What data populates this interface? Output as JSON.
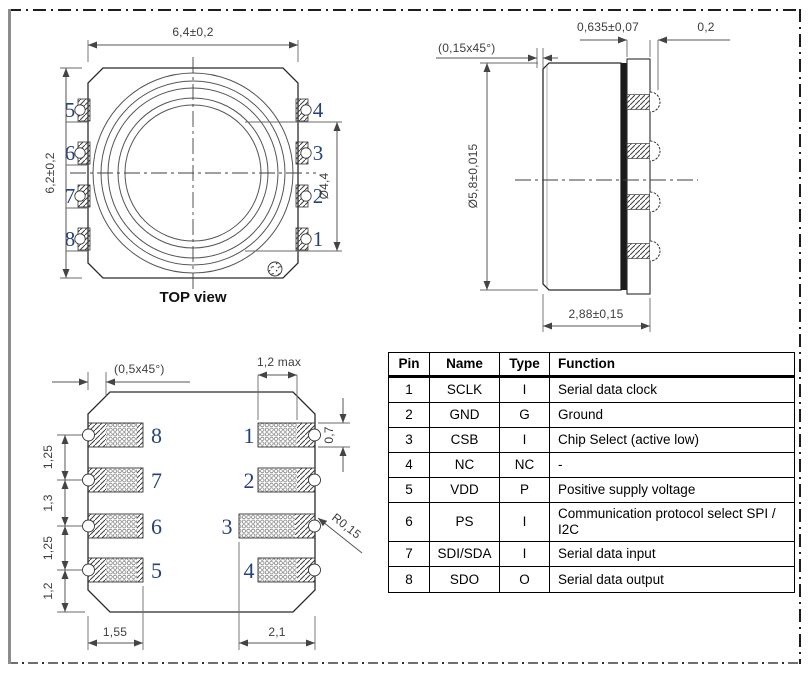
{
  "top_view": {
    "caption": "TOP view",
    "dim_width": "6,4±0,2",
    "dim_height": "6,2±0,2",
    "dim_cap_opening": "Ø4,4",
    "pins_left": [
      "5",
      "6",
      "7",
      "8"
    ],
    "pins_right": [
      "4",
      "3",
      "2",
      "1"
    ]
  },
  "side_view": {
    "dim_substrate": "0,635±0,07",
    "dim_castellation": "0,2",
    "dim_chamfer": "(0,15x45°)",
    "dim_diameter": "Ø5,8±0,015",
    "dim_height": "2,88±0,15"
  },
  "bottom_view": {
    "dim_chamfer": "(0,5x45°)",
    "dim_pad_length_max": "1,2 max",
    "dim_pad_width": "0,7",
    "dim_pitch_1": "1,25",
    "dim_pitch_2": "1,3",
    "dim_pitch_3": "1,25",
    "dim_edge": "1,2",
    "dim_left_pad_length": "1,55",
    "dim_pad3_length": "2,1",
    "dim_notch_radius": "R0,15",
    "pins_left": [
      "8",
      "7",
      "6",
      "5"
    ],
    "pins_right": [
      "1",
      "2",
      "3",
      "4"
    ]
  },
  "pin_table": {
    "headers": [
      "Pin",
      "Name",
      "Type",
      "Function"
    ],
    "rows": [
      {
        "pin": "1",
        "name": "SCLK",
        "type": "I",
        "function": "Serial data clock"
      },
      {
        "pin": "2",
        "name": "GND",
        "type": "G",
        "function": "Ground"
      },
      {
        "pin": "3",
        "name": "CSB",
        "type": "I",
        "function": "Chip Select (active low)"
      },
      {
        "pin": "4",
        "name": "NC",
        "type": "NC",
        "function": "-"
      },
      {
        "pin": "5",
        "name": "VDD",
        "type": "P",
        "function": "Positive supply voltage"
      },
      {
        "pin": "6",
        "name": "PS",
        "type": "I",
        "function": "Communication protocol select SPI / I2C"
      },
      {
        "pin": "7",
        "name": "SDI/SDA",
        "type": "I",
        "function": "Serial data input"
      },
      {
        "pin": "8",
        "name": "SDO",
        "type": "O",
        "function": "Serial data output"
      }
    ]
  },
  "colors": {
    "pin_number": "#27407e",
    "line": "#2b2b2b",
    "dim_text": "#3d3d3d"
  }
}
